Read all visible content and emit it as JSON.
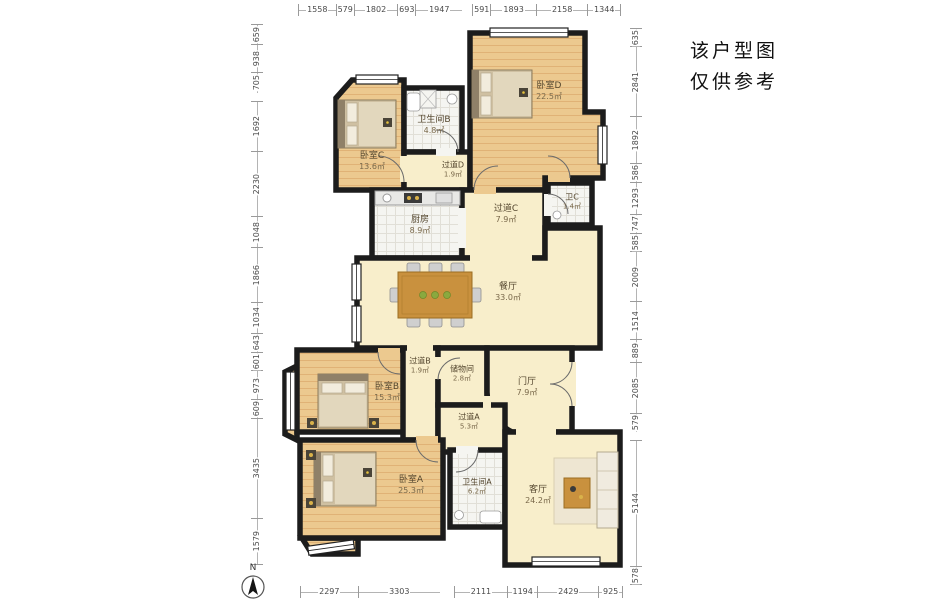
{
  "note": {
    "line1": "该户型图",
    "line2": "仅供参考"
  },
  "compass": {
    "label": "N"
  },
  "dims": {
    "top": [
      "1558",
      "579",
      "1802",
      "693",
      "1947",
      "591",
      "1893",
      "2158",
      "1344"
    ],
    "bottom": [
      "2297",
      "3303",
      "2111",
      "1194",
      "2429",
      "925"
    ],
    "left": [
      "659",
      "938",
      "705",
      "1692",
      "2230",
      "1048",
      "1866",
      "1034",
      "643",
      "601",
      "973",
      "609",
      "3435",
      "1579"
    ],
    "right": [
      "635",
      "2841",
      "1892",
      "586",
      "1293",
      "747",
      "585",
      "2009",
      "1514",
      "889",
      "2085",
      "579",
      "5144",
      "578"
    ]
  },
  "rooms": {
    "bedroom_c": {
      "label": "卧室C",
      "area": "13.6㎡"
    },
    "bathroom_b": {
      "label": "卫生间B",
      "area": "4.8㎡"
    },
    "corridor_d": {
      "label": "过道D",
      "area": "1.9㎡"
    },
    "bedroom_d": {
      "label": "卧室D",
      "area": "22.5㎡"
    },
    "kitchen": {
      "label": "厨房",
      "area": "8.9㎡"
    },
    "corridor_c": {
      "label": "过道C",
      "area": "7.9㎡"
    },
    "toilet_c": {
      "label": "卫C",
      "area": "1.4㎡"
    },
    "dining": {
      "label": "餐厅",
      "area": "33.0㎡"
    },
    "corridor_b": {
      "label": "过道B",
      "area": "1.9㎡"
    },
    "storage": {
      "label": "储物间",
      "area": "2.8㎡"
    },
    "foyer": {
      "label": "门厅",
      "area": "7.9㎡"
    },
    "bedroom_b": {
      "label": "卧室B",
      "area": "15.3㎡"
    },
    "corridor_a": {
      "label": "过道A",
      "area": "5.3㎡"
    },
    "bedroom_a": {
      "label": "卧室A",
      "area": "25.3㎡"
    },
    "bathroom_a": {
      "label": "卫生间A",
      "area": "6.2㎡"
    },
    "living": {
      "label": "客厅",
      "area": "24.2㎡"
    }
  },
  "colors": {
    "wall": "#1c1c1c",
    "wood_floor": "#ecc98f",
    "hall_floor": "#f8eecb",
    "tile_floor": "#f5f5f1",
    "table_wood": "#c9913e",
    "dim_text": "#4a4a4a"
  }
}
